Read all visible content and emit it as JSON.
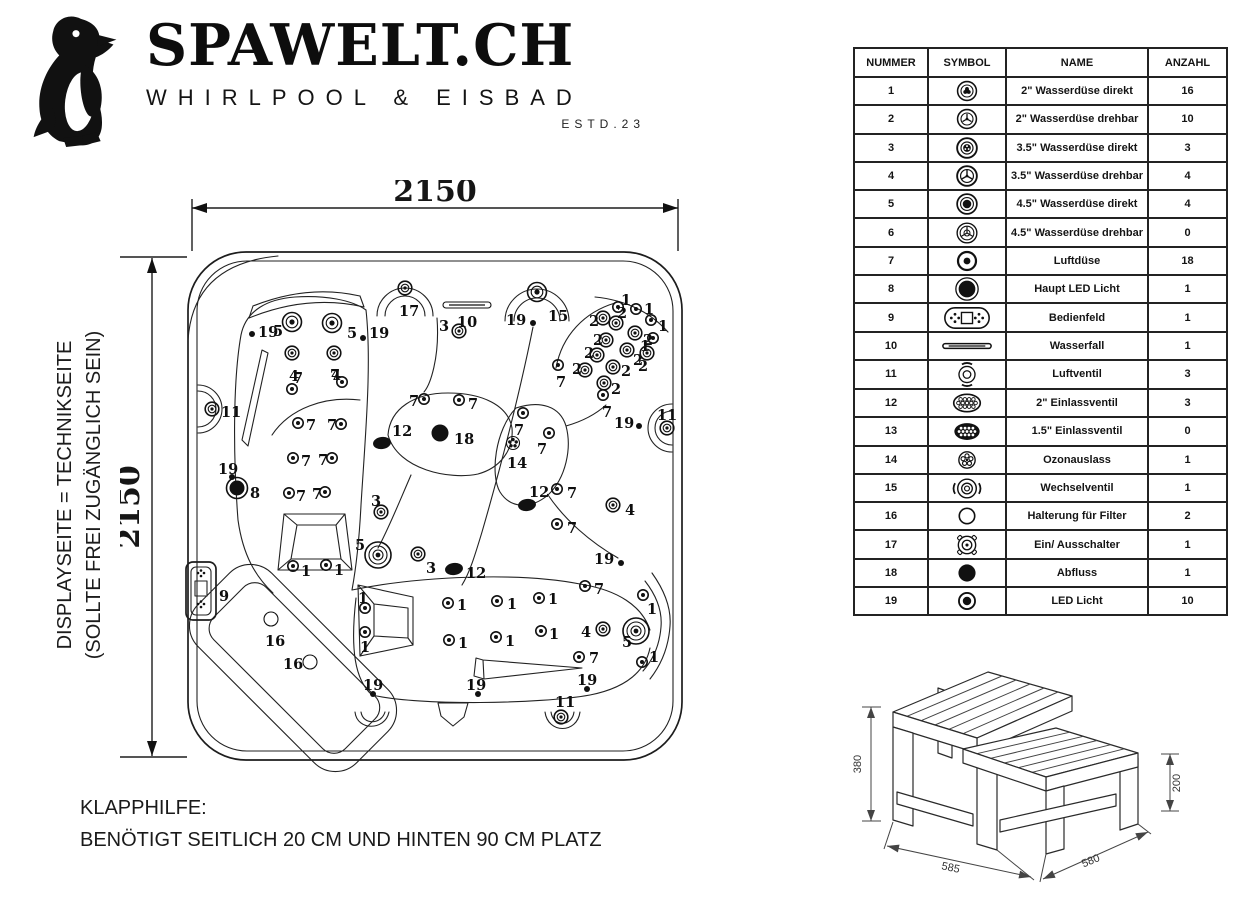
{
  "brand": {
    "name": "SPAWELT.CH",
    "tagline": "WHIRLPOOL & EISBAD",
    "estd": "ESTD.23"
  },
  "side_note": {
    "line1": "DISPLAYSEITE = TECHNIKSEITE",
    "line2": "(SOLLTE FREI ZUGÄNGLICH SEIN)"
  },
  "footnote": {
    "line1": "KLAPPHILFE:",
    "line2": "BENÖTIGT SEITLICH 20 CM UND HINTEN 90 CM PLATZ"
  },
  "diagram": {
    "width_label": "2150",
    "height_label": "2150",
    "jets": [
      {
        "n": "17",
        "x": 405,
        "y": 288,
        "t": "j2",
        "dx": -6,
        "dy": 23
      },
      {
        "n": "10",
        "x": 467,
        "y": 305,
        "t": "w",
        "dx": -10,
        "dy": 17
      },
      {
        "n": "3",
        "x": 459,
        "y": 331,
        "t": "j2",
        "dx": -20,
        "dy": -5
      },
      {
        "n": "19",
        "x": 533,
        "y": 323,
        "t": "d",
        "dx": -27,
        "dy": -3
      },
      {
        "n": "15",
        "x": 537,
        "y": 292,
        "t": "big",
        "dx": 11,
        "dy": 24
      },
      {
        "n": "19",
        "x": 252,
        "y": 334,
        "t": "d",
        "dx": 6,
        "dy": -2
      },
      {
        "n": "5",
        "x": 292,
        "y": 322,
        "t": "big",
        "dx": -19,
        "dy": 9
      },
      {
        "n": "5",
        "x": 332,
        "y": 323,
        "t": "big",
        "dx": 15,
        "dy": 10
      },
      {
        "n": "19",
        "x": 363,
        "y": 338,
        "t": "d",
        "dx": 6,
        "dy": -5
      },
      {
        "n": "4",
        "x": 292,
        "y": 353,
        "t": "j2",
        "dx": -3,
        "dy": 23
      },
      {
        "n": "4",
        "x": 334,
        "y": 353,
        "t": "j2",
        "dx": -3,
        "dy": 22
      },
      {
        "n": "7",
        "x": 292,
        "y": 389,
        "t": "j1",
        "dx": 1,
        "dy": -11
      },
      {
        "n": "7",
        "x": 342,
        "y": 382,
        "t": "j1",
        "dx": -12,
        "dy": -7
      },
      {
        "n": "11",
        "x": 212,
        "y": 409,
        "t": "j2",
        "dx": 9,
        "dy": 3
      },
      {
        "n": "19",
        "x": 232,
        "y": 477,
        "t": "d",
        "dx": -14,
        "dy": -8
      },
      {
        "n": "7",
        "x": 298,
        "y": 423,
        "t": "j1",
        "dx": 8,
        "dy": 2
      },
      {
        "n": "7",
        "x": 341,
        "y": 424,
        "t": "j1",
        "dx": -14,
        "dy": 1
      },
      {
        "n": "7",
        "x": 293,
        "y": 458,
        "t": "j1",
        "dx": 8,
        "dy": 3
      },
      {
        "n": "7",
        "x": 332,
        "y": 458,
        "t": "j1",
        "dx": -14,
        "dy": 2
      },
      {
        "n": "7",
        "x": 289,
        "y": 493,
        "t": "j1",
        "dx": 7,
        "dy": 3
      },
      {
        "n": "7",
        "x": 325,
        "y": 492,
        "t": "j1",
        "dx": -13,
        "dy": 2
      },
      {
        "n": "8",
        "x": 237,
        "y": 488,
        "t": "b8",
        "dx": 13,
        "dy": 5
      },
      {
        "n": "1",
        "x": 293,
        "y": 566,
        "t": "j1",
        "dx": 8,
        "dy": 5
      },
      {
        "n": "1",
        "x": 326,
        "y": 565,
        "t": "j1",
        "dx": 8,
        "dy": 5
      },
      {
        "n": "7",
        "x": 424,
        "y": 399,
        "t": "j1",
        "dx": -15,
        "dy": 2
      },
      {
        "n": "7",
        "x": 459,
        "y": 400,
        "t": "j1",
        "dx": 9,
        "dy": 4
      },
      {
        "n": "12",
        "x": 382,
        "y": 443,
        "t": "b12",
        "dx": 10,
        "dy": -12
      },
      {
        "n": "18",
        "x": 440,
        "y": 433,
        "t": "b18",
        "dx": 14,
        "dy": 6
      },
      {
        "n": "3",
        "x": 381,
        "y": 512,
        "t": "j2",
        "dx": -10,
        "dy": -11
      },
      {
        "n": "5",
        "x": 378,
        "y": 555,
        "t": "bigger",
        "dx": -23,
        "dy": -10
      },
      {
        "n": "3",
        "x": 418,
        "y": 554,
        "t": "j2",
        "dx": 8,
        "dy": 14
      },
      {
        "n": "12",
        "x": 454,
        "y": 569,
        "t": "b12",
        "dx": 12,
        "dy": 4
      },
      {
        "n": "7",
        "x": 523,
        "y": 413,
        "t": "j1",
        "dx": -9,
        "dy": 17
      },
      {
        "n": "14",
        "x": 513,
        "y": 443,
        "t": "f14",
        "dx": -6,
        "dy": 20
      },
      {
        "n": "7",
        "x": 549,
        "y": 433,
        "t": "j1",
        "dx": -12,
        "dy": 16
      },
      {
        "n": "12",
        "x": 527,
        "y": 505,
        "t": "b12",
        "dx": 2,
        "dy": -13
      },
      {
        "n": "7",
        "x": 557,
        "y": 489,
        "t": "j1",
        "dx": 10,
        "dy": 4
      },
      {
        "n": "7",
        "x": 557,
        "y": 524,
        "t": "j1",
        "dx": 10,
        "dy": 4
      },
      {
        "n": "4",
        "x": 613,
        "y": 505,
        "t": "j2",
        "dx": 12,
        "dy": 5
      },
      {
        "n": "1",
        "x": 618,
        "y": 307,
        "t": "j1",
        "dx": 3,
        "dy": -7
      },
      {
        "n": "1",
        "x": 636,
        "y": 309,
        "t": "j1",
        "dx": 8,
        "dy": 0
      },
      {
        "n": "1",
        "x": 651,
        "y": 320,
        "t": "j1",
        "dx": 7,
        "dy": 6
      },
      {
        "n": "1",
        "x": 653,
        "y": 338,
        "t": "j1",
        "dx": -13,
        "dy": 8
      },
      {
        "n": "2",
        "x": 603,
        "y": 318,
        "t": "j2",
        "dx": -14,
        "dy": 3
      },
      {
        "n": "2",
        "x": 616,
        "y": 323,
        "t": "j2",
        "dx": 1,
        "dy": -10
      },
      {
        "n": "2",
        "x": 606,
        "y": 340,
        "t": "j2",
        "dx": -13,
        "dy": 0
      },
      {
        "n": "2",
        "x": 635,
        "y": 333,
        "t": "j2",
        "dx": 8,
        "dy": 7
      },
      {
        "n": "2",
        "x": 597,
        "y": 355,
        "t": "j2",
        "dx": -13,
        "dy": -2
      },
      {
        "n": "2",
        "x": 627,
        "y": 350,
        "t": "j2",
        "dx": 6,
        "dy": 10
      },
      {
        "n": "2",
        "x": 647,
        "y": 353,
        "t": "j2",
        "dx": -9,
        "dy": 13
      },
      {
        "n": "2",
        "x": 585,
        "y": 370,
        "t": "j2",
        "dx": -13,
        "dy": -1
      },
      {
        "n": "2",
        "x": 613,
        "y": 367,
        "t": "j2",
        "dx": 8,
        "dy": 4
      },
      {
        "n": "2",
        "x": 604,
        "y": 383,
        "t": "j2",
        "dx": 7,
        "dy": 6
      },
      {
        "n": "7",
        "x": 558,
        "y": 365,
        "t": "j1",
        "dx": -2,
        "dy": 17
      },
      {
        "n": "7",
        "x": 603,
        "y": 395,
        "t": "j1",
        "dx": -1,
        "dy": 17
      },
      {
        "n": "19",
        "x": 639,
        "y": 426,
        "t": "d",
        "dx": -25,
        "dy": -3
      },
      {
        "n": "11",
        "x": 667,
        "y": 428,
        "t": "j2",
        "dx": -10,
        "dy": -13
      },
      {
        "n": "19",
        "x": 621,
        "y": 563,
        "t": "d",
        "dx": -27,
        "dy": -4
      },
      {
        "n": "7",
        "x": 585,
        "y": 586,
        "t": "j1",
        "dx": 9,
        "dy": 3
      },
      {
        "n": "1",
        "x": 643,
        "y": 595,
        "t": "j1",
        "dx": 4,
        "dy": 14
      },
      {
        "n": "1",
        "x": 448,
        "y": 603,
        "t": "j1",
        "dx": 9,
        "dy": 2
      },
      {
        "n": "1",
        "x": 497,
        "y": 601,
        "t": "j1",
        "dx": 10,
        "dy": 3
      },
      {
        "n": "1",
        "x": 539,
        "y": 598,
        "t": "j1",
        "dx": 9,
        "dy": 1
      },
      {
        "n": "1",
        "x": 449,
        "y": 640,
        "t": "j1",
        "dx": 9,
        "dy": 3
      },
      {
        "n": "1",
        "x": 496,
        "y": 637,
        "t": "j1",
        "dx": 9,
        "dy": 4
      },
      {
        "n": "1",
        "x": 541,
        "y": 631,
        "t": "j1",
        "dx": 8,
        "dy": 3
      },
      {
        "n": "4",
        "x": 603,
        "y": 629,
        "t": "j2",
        "dx": -22,
        "dy": 3
      },
      {
        "n": "5",
        "x": 636,
        "y": 631,
        "t": "bigger",
        "dx": -14,
        "dy": 11
      },
      {
        "n": "7",
        "x": 579,
        "y": 657,
        "t": "j1",
        "dx": 10,
        "dy": 1
      },
      {
        "n": "1",
        "x": 642,
        "y": 662,
        "t": "j1",
        "dx": 7,
        "dy": -5
      },
      {
        "n": "1",
        "x": 365,
        "y": 608,
        "t": "j1",
        "dx": -7,
        "dy": -10
      },
      {
        "n": "1",
        "x": 365,
        "y": 632,
        "t": "j1",
        "dx": -5,
        "dy": 15
      },
      {
        "n": "16",
        "x": 271,
        "y": 619,
        "t": "o",
        "dx": -6,
        "dy": 22
      },
      {
        "n": "16",
        "x": 310,
        "y": 662,
        "t": "o",
        "dx": -27,
        "dy": 2
      },
      {
        "n": "19",
        "x": 373,
        "y": 694,
        "t": "d",
        "dx": -10,
        "dy": -9
      },
      {
        "n": "19",
        "x": 478,
        "y": 694,
        "t": "d",
        "dx": -12,
        "dy": -9
      },
      {
        "n": "19",
        "x": 587,
        "y": 689,
        "t": "d",
        "dx": -10,
        "dy": -9
      },
      {
        "n": "11",
        "x": 561,
        "y": 717,
        "t": "j2",
        "dx": -6,
        "dy": -15
      },
      {
        "n": "9",
        "x": 219,
        "y": 592,
        "t": "lbl",
        "dx": 0,
        "dy": 4
      }
    ]
  },
  "steps": {
    "height_total": "380",
    "height_step": "200",
    "depth_left": "585",
    "depth_right": "580"
  },
  "table": {
    "headers": [
      "NUMMER",
      "SYMBOL",
      "NAME",
      "ANZAHL"
    ],
    "rows": [
      {
        "num": "1",
        "icon": "jet-direct-2",
        "name": "2\" Wasserdüse direkt",
        "qty": "16"
      },
      {
        "num": "2",
        "icon": "jet-rotate-2",
        "name": "2\" Wasserdüse drehbar",
        "qty": "10"
      },
      {
        "num": "3",
        "icon": "jet-direct-35",
        "name": "3.5\" Wasserdüse direkt",
        "qty": "3"
      },
      {
        "num": "4",
        "icon": "jet-rotate-35",
        "name": "3.5\" Wasserdüse drehbar",
        "qty": "4"
      },
      {
        "num": "5",
        "icon": "jet-direct-45",
        "name": "4.5\" Wasserdüse direkt",
        "qty": "4"
      },
      {
        "num": "6",
        "icon": "jet-rotate-45",
        "name": "4.5\" Wasserdüse drehbar",
        "qty": "0"
      },
      {
        "num": "7",
        "icon": "air-jet",
        "name": "Luftdüse",
        "qty": "18"
      },
      {
        "num": "8",
        "icon": "main-led",
        "name": "Haupt LED Licht",
        "qty": "1"
      },
      {
        "num": "9",
        "icon": "control-panel",
        "name": "Bedienfeld",
        "qty": "1"
      },
      {
        "num": "10",
        "icon": "waterfall",
        "name": "Wasserfall",
        "qty": "1"
      },
      {
        "num": "11",
        "icon": "air-valve",
        "name": "Luftventil",
        "qty": "3"
      },
      {
        "num": "12",
        "icon": "inlet-2",
        "name": "2\" Einlassventil",
        "qty": "3"
      },
      {
        "num": "13",
        "icon": "inlet-15",
        "name": "1.5\" Einlassventil",
        "qty": "0"
      },
      {
        "num": "14",
        "icon": "ozone",
        "name": "Ozonauslass",
        "qty": "1"
      },
      {
        "num": "15",
        "icon": "diverter",
        "name": "Wechselventil",
        "qty": "1"
      },
      {
        "num": "16",
        "icon": "filter-holder",
        "name": "Halterung für Filter",
        "qty": "2"
      },
      {
        "num": "17",
        "icon": "on-off",
        "name": "Ein/ Ausschalter",
        "qty": "1"
      },
      {
        "num": "18",
        "icon": "drain",
        "name": "Abfluss",
        "qty": "1"
      },
      {
        "num": "19",
        "icon": "led",
        "name": "LED Licht",
        "qty": "10"
      }
    ]
  },
  "colors": {
    "ink": "#111111",
    "paper": "#ffffff"
  }
}
